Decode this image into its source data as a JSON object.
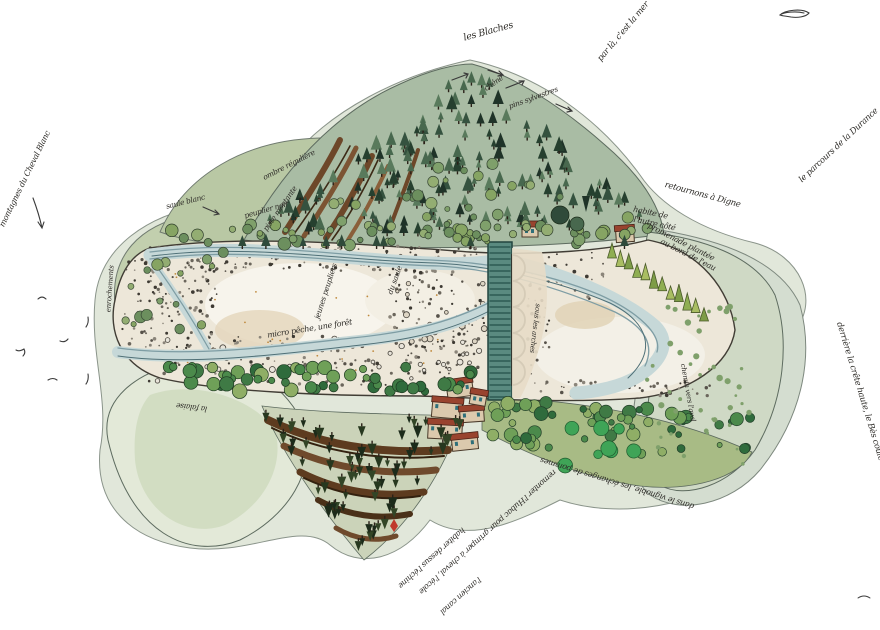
{
  "figure": {
    "kind": "hand-drawn watercolor map",
    "subject": "braided river valley with a footbridge, forested mountain, terraced slopes and a village"
  },
  "palette": {
    "wash_outer": "#e1e7da",
    "terrain_green": "#bcc9a3",
    "forest_dark": "#2f4a3a",
    "gravel": "#ede7d9",
    "water": "#c6d8d8",
    "water_line": "#6f8d93",
    "bridge_teal": "#5a8a80",
    "roof_red": "#99432e",
    "ravine_brown": "#6d4729",
    "ink": "#2e2c28"
  },
  "icons": {
    "squiggle": "hand-drawn loop sketch (top-right)"
  },
  "annotations": [
    {
      "text": "les Blaches"
    },
    {
      "text": "par là, c'est la mer"
    },
    {
      "text": "le parcours de la Durance"
    },
    {
      "text": "retournons à Digne"
    },
    {
      "text": "habite de"
    },
    {
      "text": "l'autre côté"
    },
    {
      "text": "promenade plantée"
    },
    {
      "text": "au bord de l'eau"
    },
    {
      "text": "derrière la crête haute, le Bès coule"
    },
    {
      "text": "chêne"
    },
    {
      "text": "pins sylvestres"
    },
    {
      "text": "saule blanc"
    },
    {
      "text": "peuplier noir"
    },
    {
      "text": "ombre régulière"
    },
    {
      "text": "piste montante"
    },
    {
      "text": "jeunes peupliers"
    },
    {
      "text": "du saule"
    },
    {
      "text": "micro pêche, une forêt"
    },
    {
      "text": "enrochements"
    },
    {
      "text": "montagnes du Cheval Blanc"
    },
    {
      "text": "la falaise"
    },
    {
      "text": "sous les arches"
    },
    {
      "text": "chemin vers l'aval"
    },
    {
      "text": "dans le vignoble, les échanges de pommes"
    },
    {
      "text": "remonter l'Hubac pour grimper à cheval, l'école"
    },
    {
      "text": "habiter dessus l'échine"
    },
    {
      "text": "l'ancien canal"
    }
  ]
}
